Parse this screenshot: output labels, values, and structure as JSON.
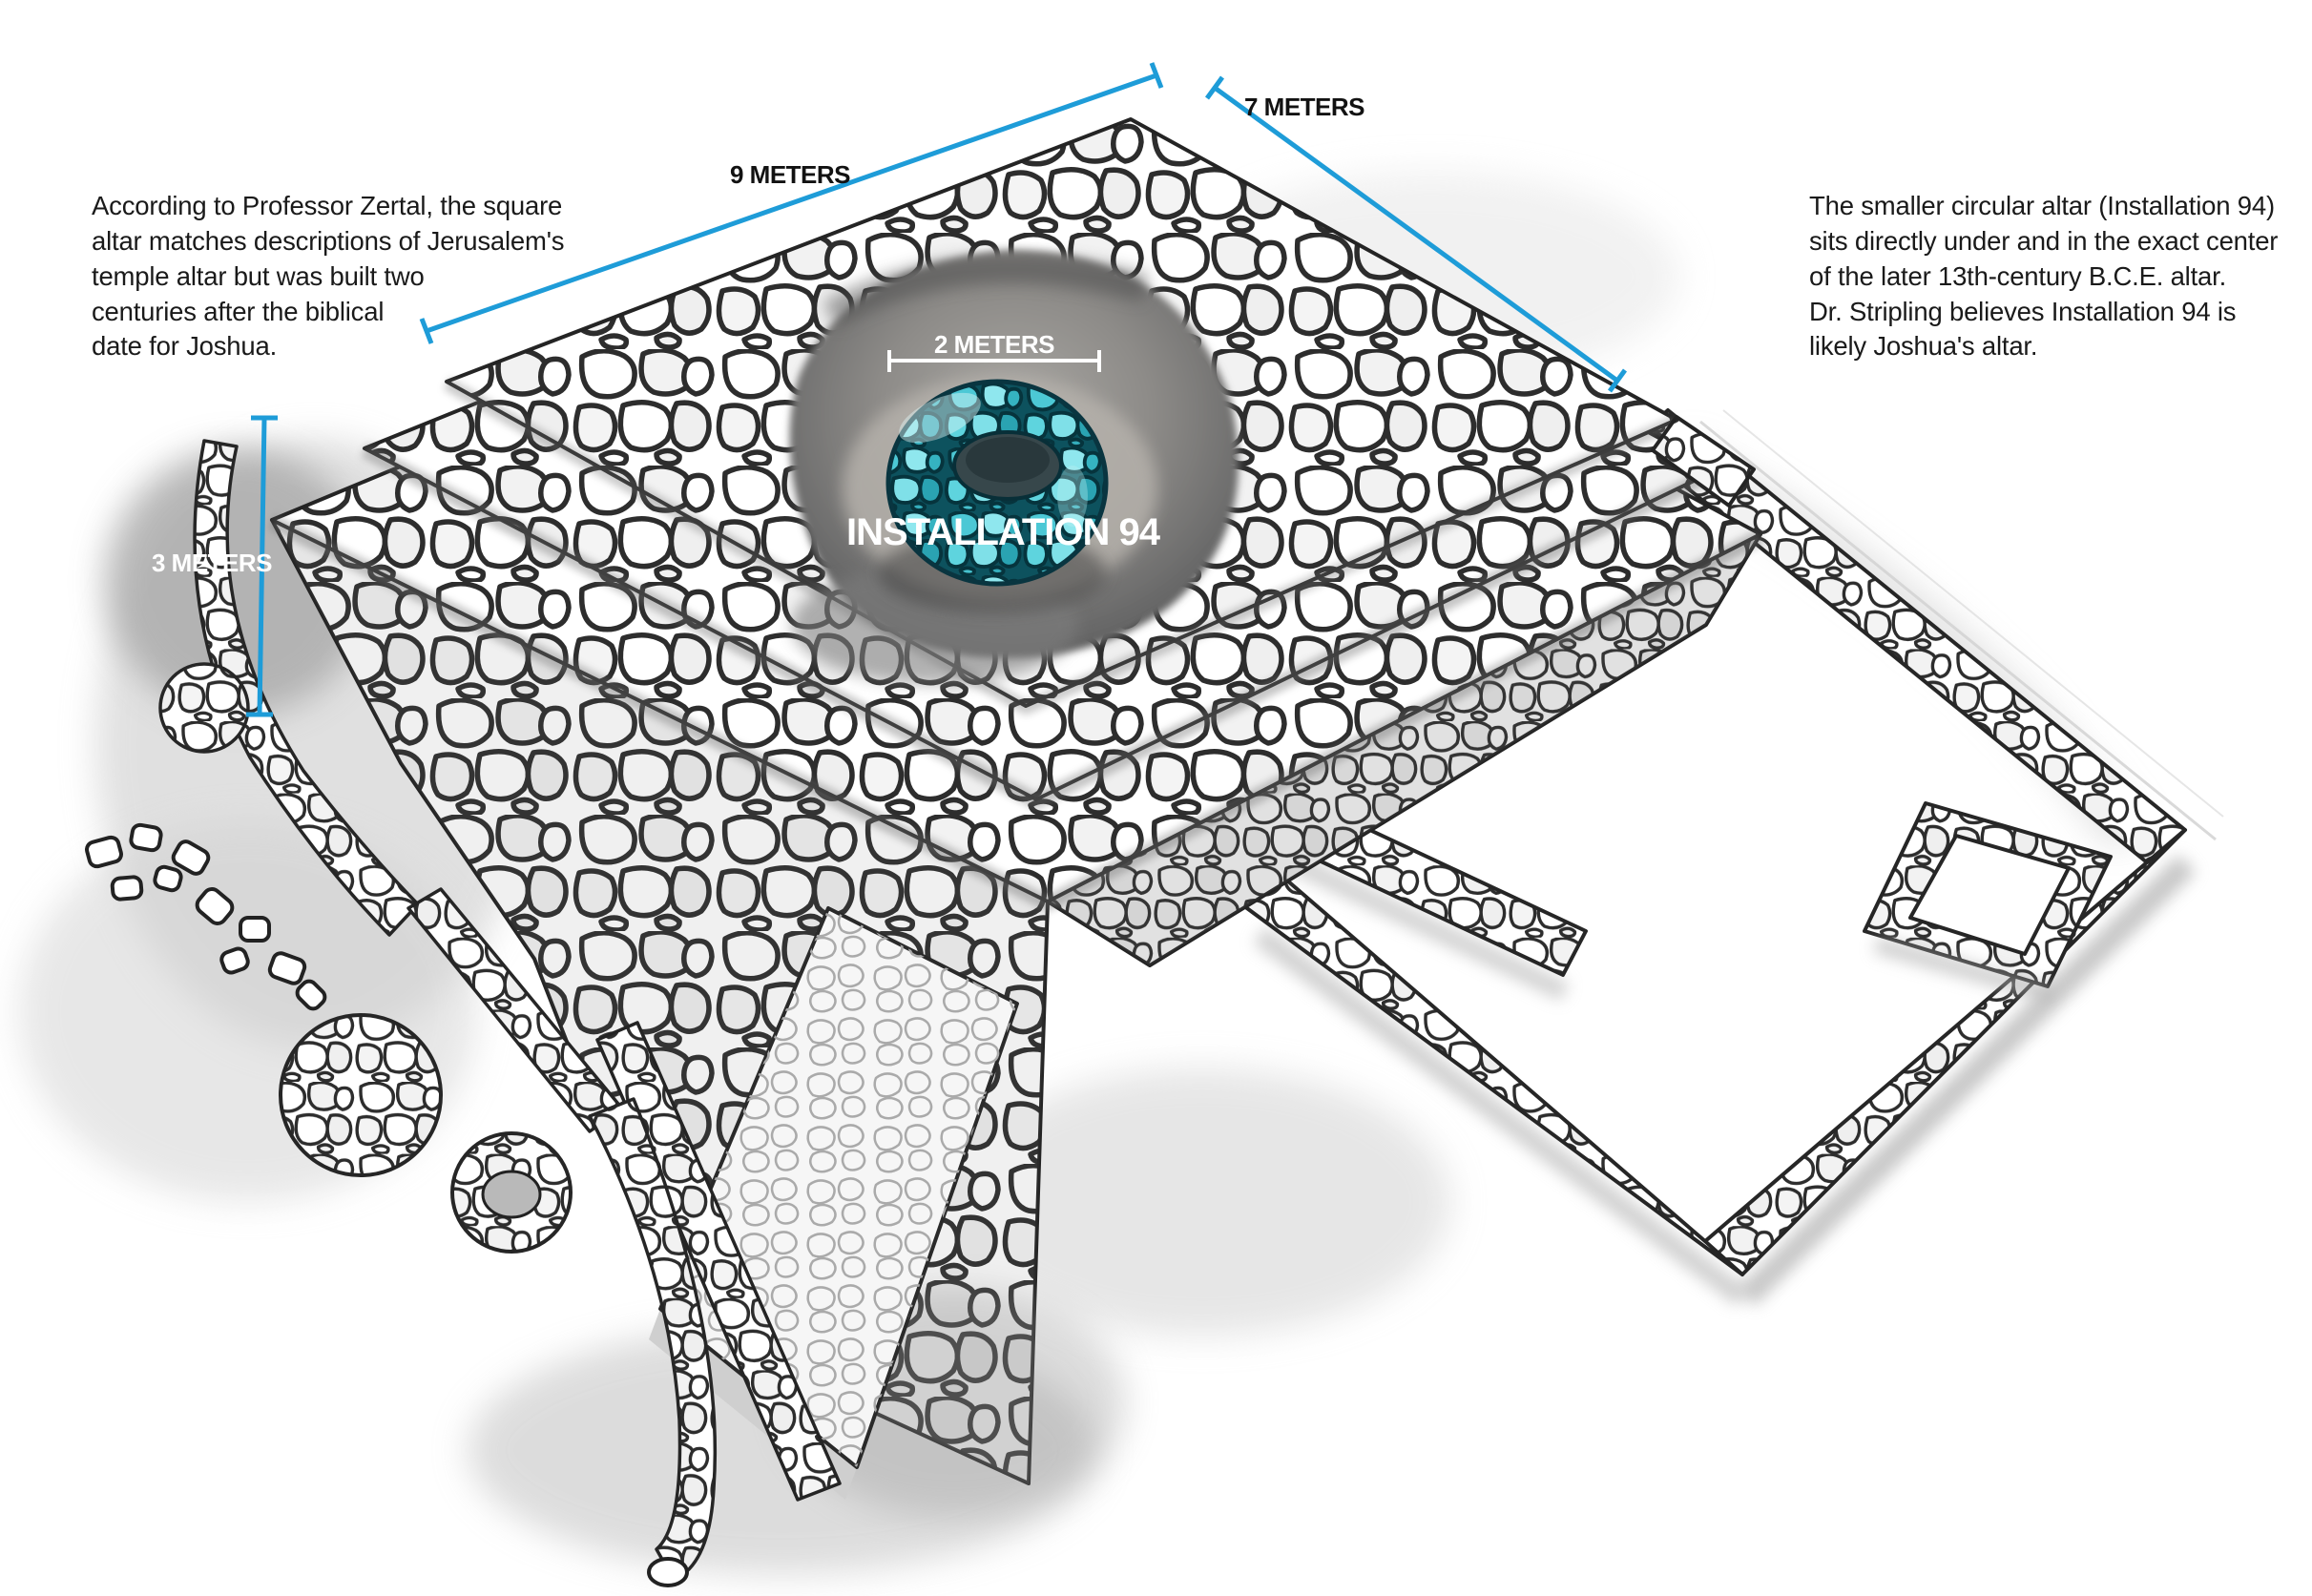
{
  "figure": {
    "notes": {
      "left": "According to Professor Zertal, the square\naltar matches descriptions of Jerusalem's\ntemple altar but was built two\ncenturies after the biblical\ndate for Joshua.",
      "right": "The smaller circular altar (Installation 94)\nsits directly under and in the exact center\nof the later 13th-century B.C.E. altar.\nDr. Stripling believes Installation 94 is\nlikely Joshua's altar."
    },
    "measurements": [
      {
        "id": "square-altar-width",
        "label": "9 METERS"
      },
      {
        "id": "square-altar-depth",
        "label": "7 METERS"
      },
      {
        "id": "square-altar-height",
        "label": "3 METERS"
      },
      {
        "id": "installation-diameter",
        "label": "2 METERS"
      }
    ],
    "installation": {
      "label": "INSTALLATION 94"
    },
    "colors": {
      "measurement_blue": "#1e9cd8",
      "label_dark": "#121212",
      "label_light": "#ffffff",
      "ring_teal": "#2fb6c4",
      "ring_teal_deep": "#0d525e",
      "pit_gray": "#6b6b6b"
    }
  }
}
